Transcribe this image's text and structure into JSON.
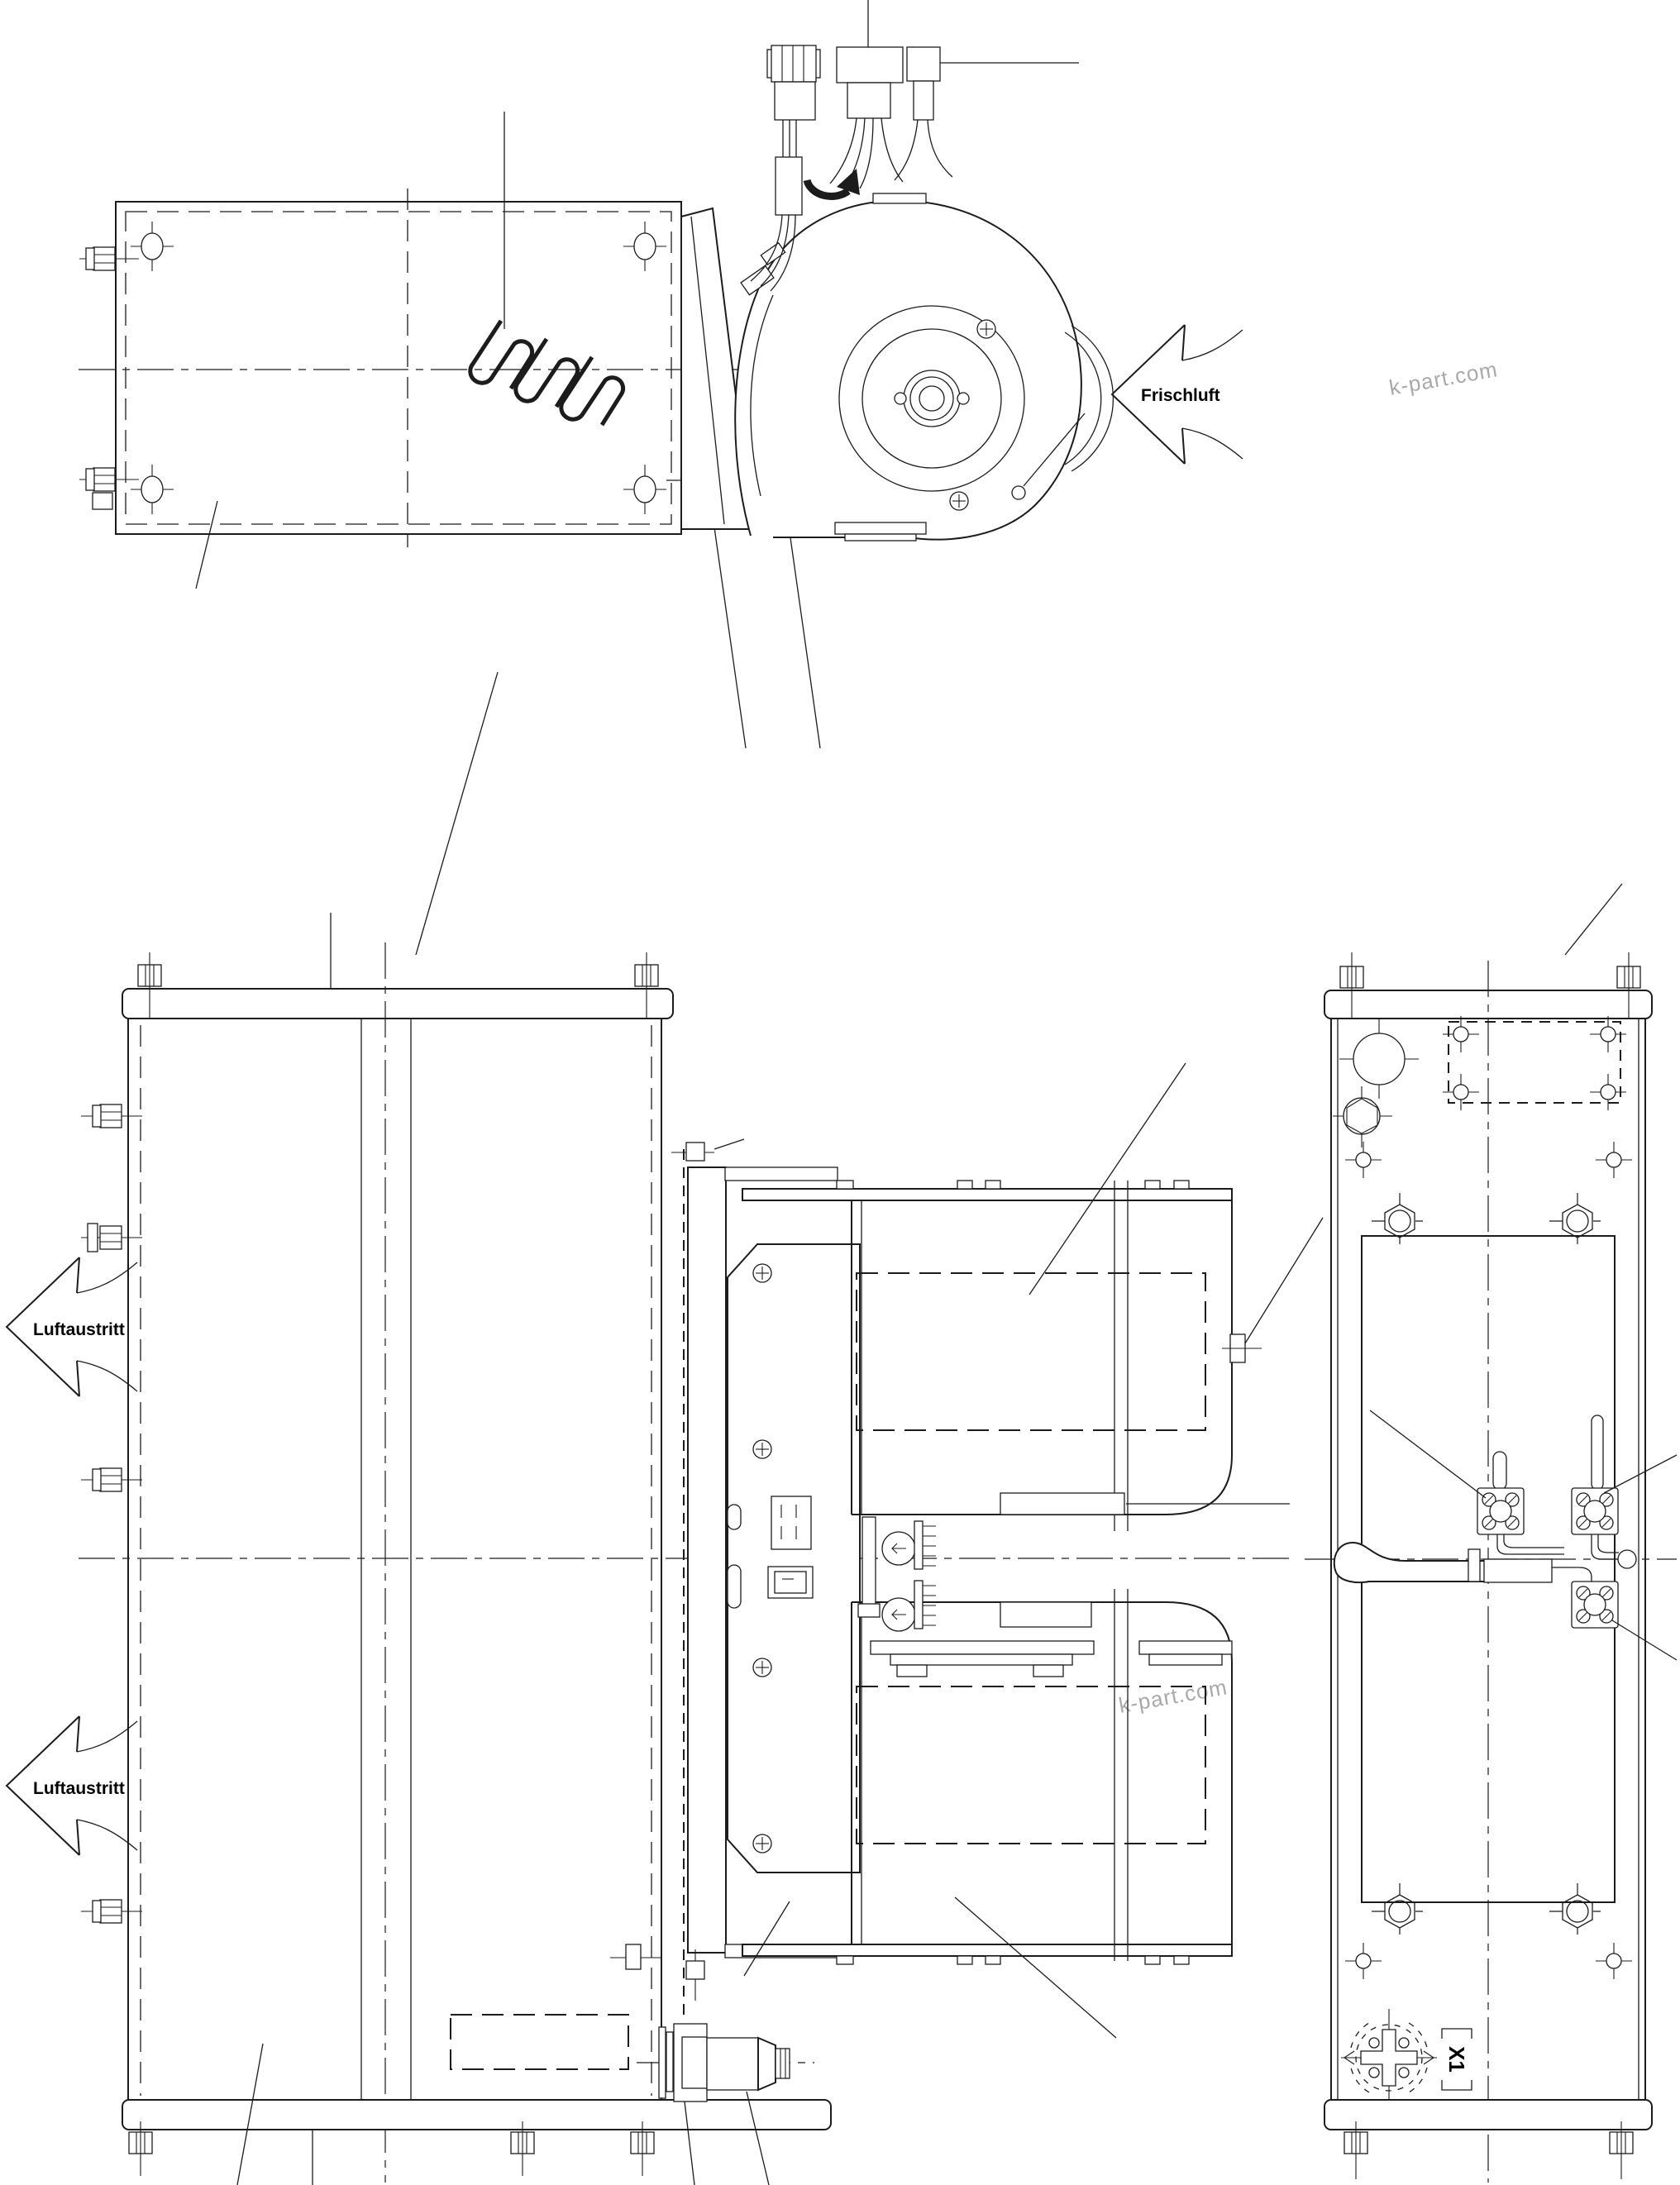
{
  "drawing": {
    "labels": {
      "fresh_air": "Frischluft",
      "air_outlet_top": "Luftaustritt",
      "air_outlet_bottom": "Luftaustritt",
      "terminal_x1": "X1"
    },
    "watermarks": {
      "wm_top_left": "k-part.com",
      "wm_top_right": "k-part.com",
      "wm_bottom_left": "k-part.com",
      "wm_bottom_right": "k-part.com"
    },
    "colors": {
      "line": "#1c1c1c",
      "label_text": "#000000",
      "watermark": "#a9a9a9",
      "background": "#ffffff"
    }
  }
}
